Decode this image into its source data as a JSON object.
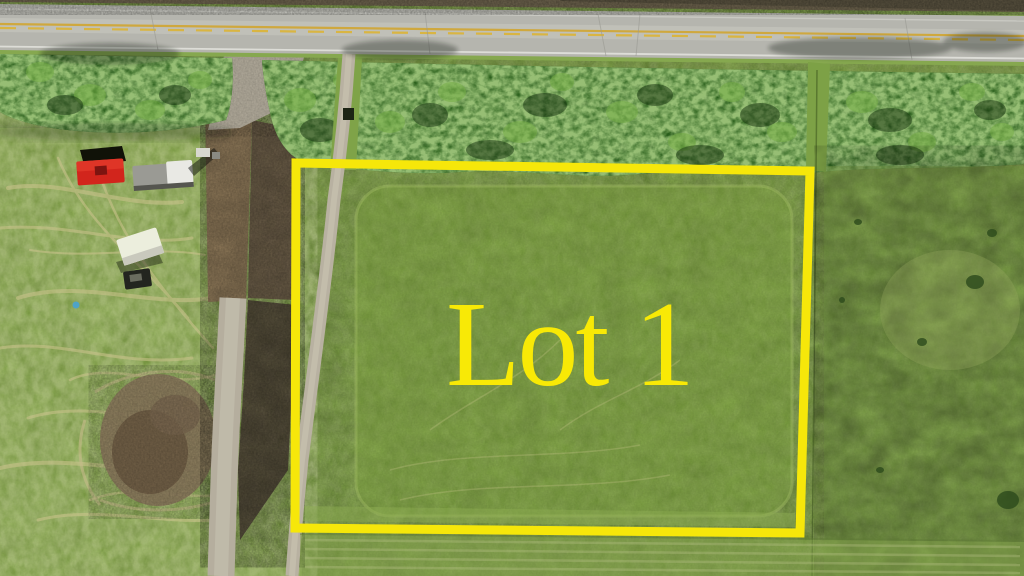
{
  "lot": {
    "label": "Lot 1"
  },
  "colors": {
    "label": "#f8e906",
    "boundary": "#f6e70a",
    "road_asphalt": "#b5b5ae",
    "road_centerline_yellow": "#d9b542",
    "road_edge_white": "#e8e8e2",
    "grass_field": "#7fa444",
    "left_field_grass": "#8fae52",
    "dry_grass_streaks": "#cdc48e",
    "forest_trees": "#2e5621",
    "dirt_brown": "#937d5c",
    "dark_dirt": "#4e4136",
    "gravel_path": "#b6b09f",
    "mud_patch": "#8c7b5e",
    "truck_red": "#d2251c",
    "trailer_white": "#eceedd",
    "barrel_blue": "#4fa3c6",
    "top_soil_strip": "#6a604b"
  }
}
